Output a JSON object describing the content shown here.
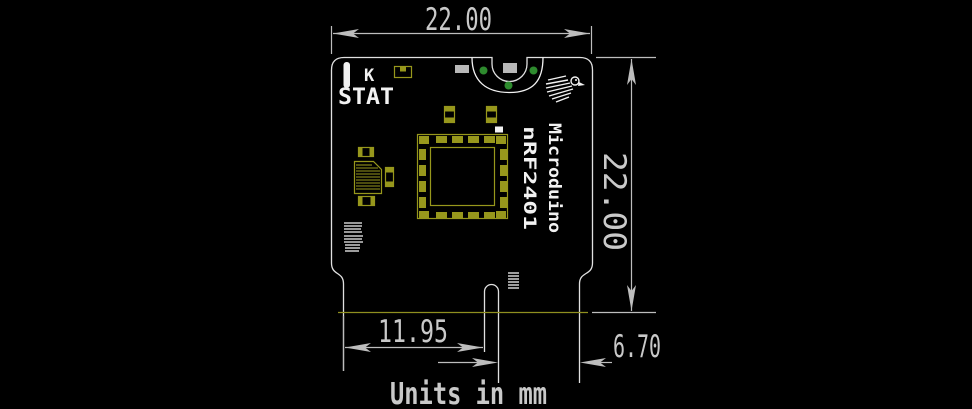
{
  "drawing": {
    "units_note": "Units in mm",
    "dim_width": "22.00",
    "dim_height": "22.00",
    "dim_slot_from_left": "11.95",
    "dim_slot_to_right": "6.70"
  },
  "board_silk": {
    "led_label": "K",
    "stat_label": "STAT",
    "vertical_text_line1": "Microduino",
    "vertical_text_line2": "nRF2401"
  },
  "icons": {
    "logo": "bird-logo"
  },
  "colors": {
    "background": "#000000",
    "dimension": "#bdbdbd",
    "board_outline": "#e0e0e0",
    "silkscreen": "#f2f2f2",
    "copper_pad": "#97971c",
    "plated_hole_green": "#2e8b2e",
    "bottom_layer_line": "#8f8f1f"
  }
}
